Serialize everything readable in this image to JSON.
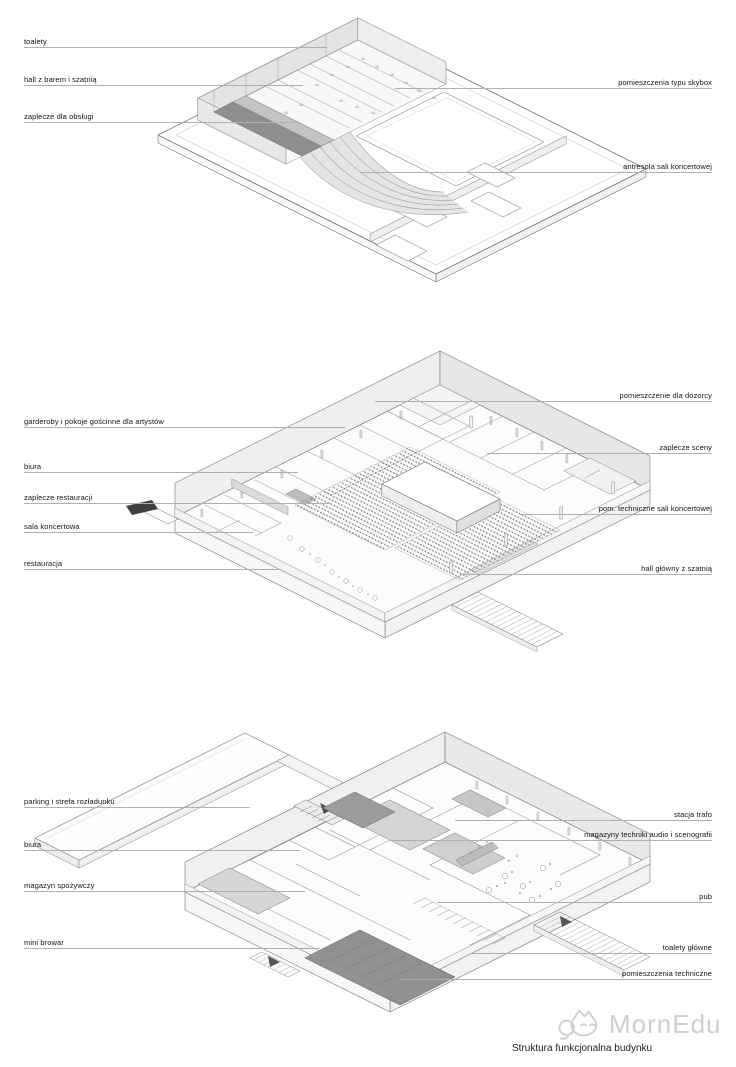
{
  "caption": "Struktura funkcjonalna budynku",
  "watermark": {
    "text": "MornEdu",
    "icon": "chat-bubble-cat-logo",
    "color": "#cfcfcf"
  },
  "colors": {
    "background": "#ffffff",
    "drawing_line": "#777777",
    "leader_line": "#b0b0b0",
    "label_text": "#141414",
    "dark_room": "#8f8f8f",
    "medium_room": "#cfcfcf",
    "amphitheater_fill": "#e4e4e4",
    "watermark_gray": "#cfcfcf"
  },
  "floors": {
    "top": {
      "labels_left": [
        "toalety",
        "hall z barem i szatnią",
        "zaplecze dla obsługi"
      ],
      "labels_right": [
        "pomieszczenia typu skybox",
        "antresola sali koncertowej"
      ]
    },
    "middle": {
      "labels_left": [
        "garderoby i pokoje gościnne dla artystów",
        "biura",
        "zaplecze restauracji",
        "sala koncertowa",
        "restauracja"
      ],
      "labels_right": [
        "pomieszczenie dla dozorcy",
        "zaplecze sceny",
        "pom. techniczne sali koncertowej",
        "hall główny z szatnią"
      ]
    },
    "bottom": {
      "labels_left": [
        "parking i strefa rozładunku",
        "biura",
        "magazyn spożywczy",
        "mini browar"
      ],
      "labels_right": [
        "stacja trafo",
        "magazyny techniki audio i scenografii",
        "pub",
        "toalety główne",
        "pomieszczenia techniczne"
      ]
    }
  }
}
